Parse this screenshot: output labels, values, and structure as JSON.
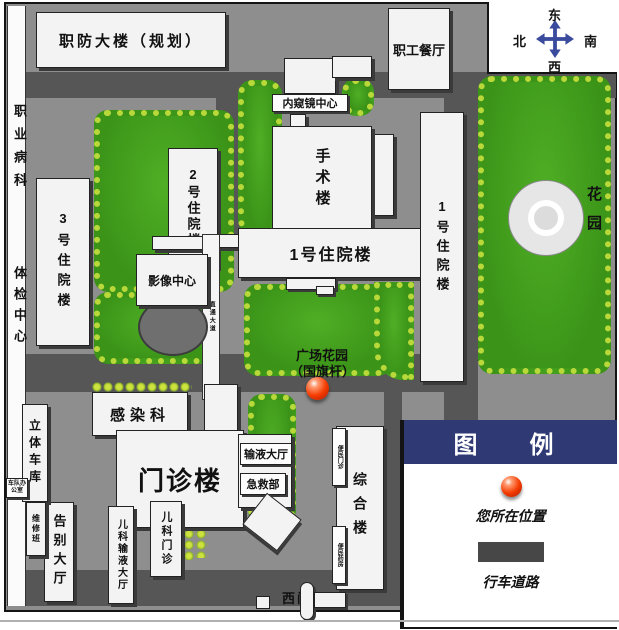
{
  "buildings": {
    "zhifang": "职防大楼（规划）",
    "canting": "职工餐厅",
    "neikuijing": "内窥镜中心",
    "shoushu": "手术楼",
    "yihao": "1号住院楼",
    "erhao": "2号住院楼",
    "sanhao": "3号住院楼",
    "yingxiang": "影像中心",
    "ganranke": "感染科",
    "menzhen": "门诊楼",
    "shuye": "输液大厅",
    "jijiu": "急救部",
    "zonghe": "综合楼",
    "bianmin_menzhen": "便民门诊",
    "bianmin_yaofang": "便民药房",
    "gaobie": "告别大厅",
    "erke_shuye": "儿科输液大厅",
    "erke_menzhen": "儿科门诊",
    "litiche": "立体车库",
    "chedui": "车队办公室",
    "weixiu": "维修班",
    "zhiye": "职业病科",
    "tijian": "体检中心"
  },
  "areas": {
    "huayuan": "花园",
    "plaza_line1": "广场花园",
    "plaza_line2": "（国旗杆）",
    "corridor": "直通大道"
  },
  "gates": {
    "west": "西门"
  },
  "compass": {
    "top": "东",
    "left": "北",
    "right": "南",
    "bottom": "西"
  },
  "legend": {
    "title": "图　例",
    "you_are_here": "您所在位置",
    "road": "行车道路"
  },
  "colors": {
    "road": "#565656",
    "base": "#8e8e8e",
    "lawn": "#3f9c1e",
    "bush": "#b9d83a",
    "building": "#f3f3f3",
    "legend_header": "#2f3a75",
    "marker": "#f43b00"
  }
}
